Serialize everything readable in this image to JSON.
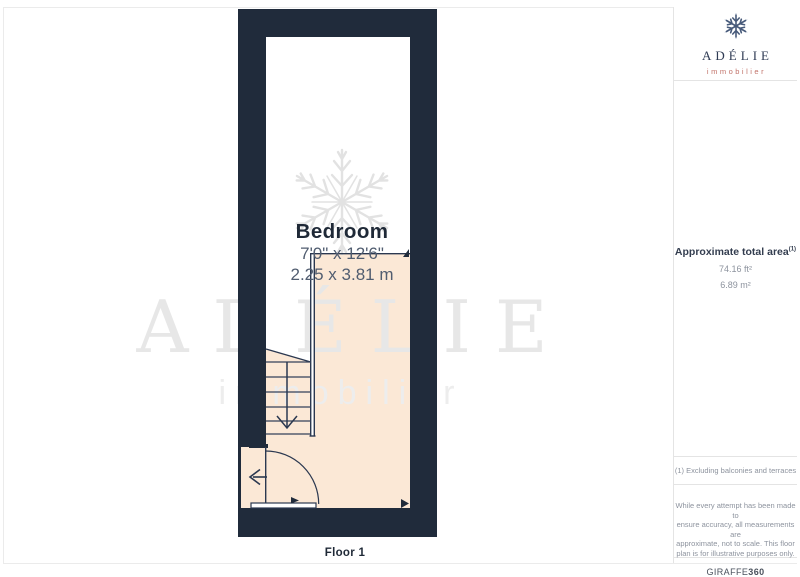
{
  "page": {
    "floor_label": "Floor 1"
  },
  "floorplan": {
    "room": {
      "name": "Bedroom",
      "dimensions_imperial": "7'0\" x 12'6\"",
      "dimensions_metric": "2.25 x 3.81 m"
    },
    "colors": {
      "wall": "#202b3b",
      "floor_fill": "#fbe8d6",
      "line": "#2b3850",
      "watermark": "#e7e7e7",
      "accent": "#c2736a"
    }
  },
  "watermark": {
    "brand": "ADÉLIE",
    "sub": "immobilier"
  },
  "sidebar": {
    "logo": {
      "brand": "ADÉLIE",
      "sub": "immobilier"
    },
    "area": {
      "title": "Approximate total area",
      "title_sup": "(1)",
      "imperial": "74.16 ft²",
      "metric": "6.89 m²"
    },
    "note": "(1) Excluding balconies and terraces",
    "disclaimer": {
      "lines": [
        "While every attempt has been made to",
        "ensure accuracy, all measurements are",
        "approximate, not to scale. This floor",
        "plan is for illustrative purposes only."
      ],
      "brand": "GIRAFFE",
      "brand_bold": "360"
    }
  }
}
